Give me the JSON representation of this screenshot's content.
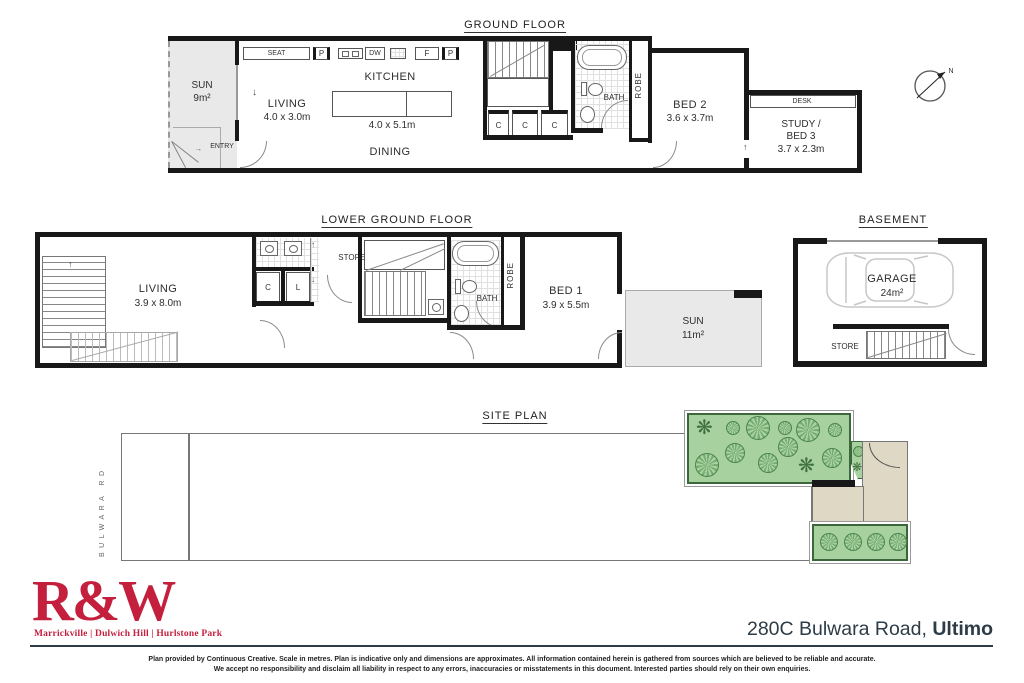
{
  "icons": {
    "arrow_up": "↑",
    "arrow_down": "↓",
    "arrow_right": "→",
    "fern": "❋"
  },
  "colors": {
    "brand_red": "#c41f3d",
    "navy": "#2d3c47",
    "garden_green": "#a7d2a0",
    "tree_green": "#4c854a",
    "courtyard_beige": "#ded8c4",
    "wall_black": "#181818"
  },
  "ground_floor": {
    "title": "GROUND FLOOR",
    "sun": {
      "name": "SUN",
      "area": "9m²"
    },
    "entry": "ENTRY",
    "living": {
      "name": "LIVING",
      "dims": "4.0 x 3.0m"
    },
    "kitchen": {
      "name": "KITCHEN",
      "dims": "4.0 x 5.1m"
    },
    "dining": "DINING",
    "seat": "SEAT",
    "pantry": "P",
    "dishwasher": "DW",
    "fridge": "F",
    "cupboard": "C",
    "bath": "BATH",
    "robe": "ROBE",
    "bed2": {
      "name": "BED 2",
      "dims": "3.6 x 3.7m"
    },
    "desk": "DESK",
    "study": {
      "line1": "STUDY /",
      "line2": "BED 3",
      "dims": "3.7 x 2.3m"
    },
    "compass": "N"
  },
  "lower_ground_floor": {
    "title": "LOWER GROUND FLOOR",
    "living": {
      "name": "LIVING",
      "dims": "3.9 x 8.0m"
    },
    "cupboard": "C",
    "linen": "L",
    "store": "STORE",
    "bath": "BATH",
    "robe": "ROBE",
    "bed1": {
      "name": "BED 1",
      "dims": "3.9 x 5.5m"
    },
    "sun": {
      "name": "SUN",
      "area": "11m²"
    }
  },
  "basement": {
    "title": "BASEMENT",
    "garage": {
      "name": "GARAGE",
      "area": "24m²"
    },
    "store": "STORE"
  },
  "site_plan": {
    "title": "SITE PLAN",
    "street": "BULWARA RD"
  },
  "footer": {
    "logo": "R&W",
    "offices": "Marrickville | Dulwich Hill | Hurlstone Park",
    "address_main": "280C Bulwara Road,",
    "address_bold": "Ultimo",
    "disclaimer_line1": "Plan provided by Continuous Creative. Scale in metres. Plan is indicative only and dimensions are approximates. All information contained herein is gathered from sources which are believed to be reliable and accurate.",
    "disclaimer_line2": "We accept no responsibility and disclaim all liability in respect to any errors, inaccuracies or misstatements in this document. Interested parties should rely on their own enquiries."
  }
}
